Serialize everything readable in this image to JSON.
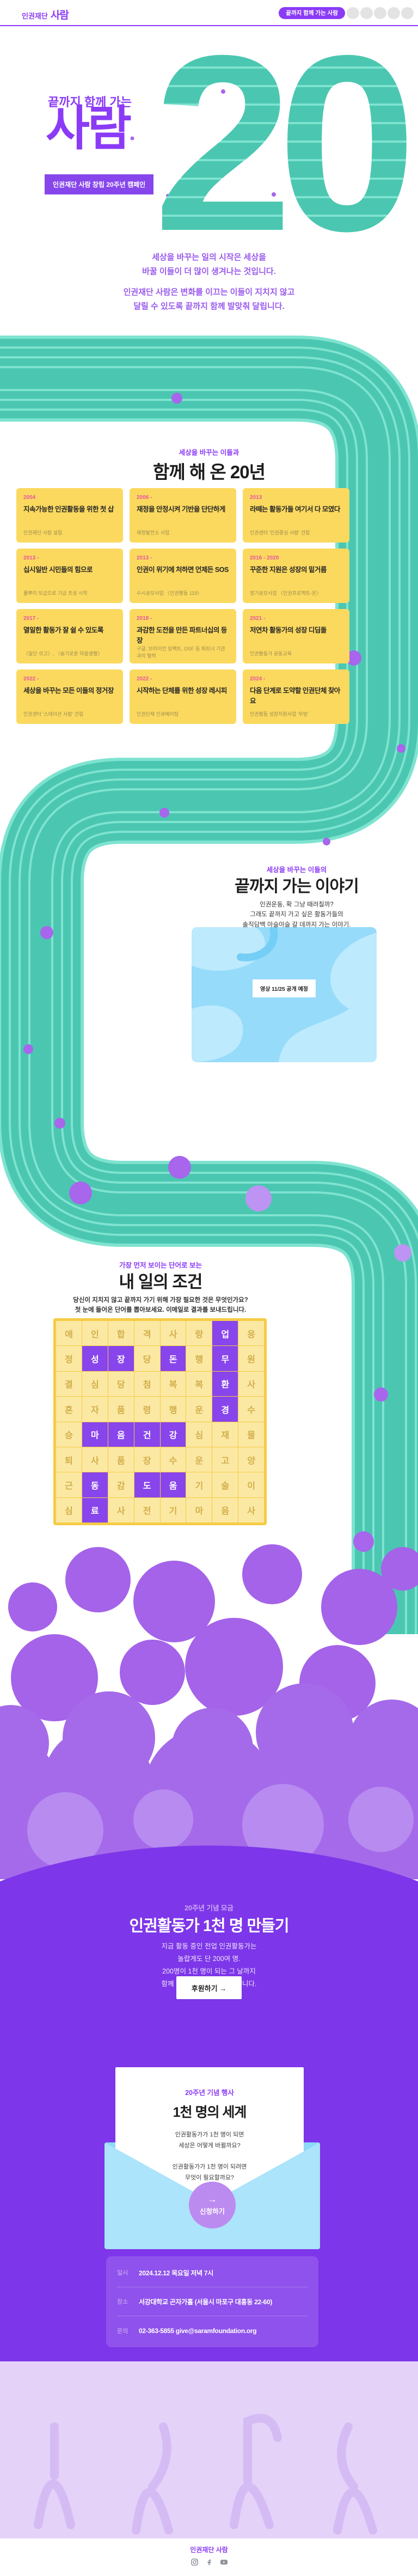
{
  "page_title": "끝까지 함께 가는 사람",
  "palette": {
    "accent_purple": "#8B3BF6",
    "deep_purple": "#7D36E9",
    "cloud_purple": "#A56AE9",
    "track_teal": "#4BC7B1",
    "track_stripe": "#7FE3D0",
    "card_yellow": "#FBD95F",
    "year_pink": "#E8559C",
    "sky_blue": "#ABE4FB",
    "grid_highlight": "#8845EC"
  },
  "header": {
    "logo_prefix": "인권재단",
    "logo_name": "사람",
    "cta": "끝까지 함께 가는 사람"
  },
  "hero": {
    "eyebrow": "끝까지 함께 가는",
    "title": "사람",
    "badge": "인권재단 사람 창립 20주년 캠페인",
    "numeral": "20"
  },
  "intro": {
    "p1": "세상을 바꾸는 일의 시작은 세상을\n바꿀 이들이 더 많이 생겨나는 것입니다.",
    "p2": "인권재단 사람은 변화를 이끄는 이들이 지치지 않고\n달릴 수 있도록 끝까지 함께 발맞춰 달립니다."
  },
  "history": {
    "eyebrow": "세상을 바꾸는 이들과",
    "title": "함께 해 온 20년",
    "cards": [
      {
        "year": "2004",
        "title": "지속가능한 인권활동을 위한 첫 삽",
        "desc": "인권재단 사람 설립"
      },
      {
        "year": "2006 -",
        "title": "재정을 안정시켜 기반을 단단하게",
        "desc": "재정발전소 사업"
      },
      {
        "year": "2013",
        "title": "라떼는 활동가들 여기서 다 모였다",
        "desc": "인권센터 '인권중심 사람' 건립"
      },
      {
        "year": "2013 -",
        "title": "십시일반 시민들의 힘으로",
        "desc": "풀뿌리 모금으로 기금 조성 시작"
      },
      {
        "year": "2013 -",
        "title": "인권이 위기에 처하면 언제든 SOS",
        "desc": "수시공모사업 〈인권활동 119〉"
      },
      {
        "year": "2016 - 2020",
        "title": "꾸준한 지원은 성장의 밑거름",
        "desc": "정기공모사업 〈인권프로젝트-온〉"
      },
      {
        "year": "2017 -",
        "title": "열일한 활동가 잘 쉴 수 있도록",
        "desc": "〈일단 쉬고〉, 〈슬기로운 마음생활〉"
      },
      {
        "year": "2018 -",
        "title": "과감한 도전을 만든 파트너십의 등장",
        "desc": "구글, 브라이언 임팩트, OSF 등 파트너 기관과의 협력"
      },
      {
        "year": "2021 -",
        "title": "저연차 활동가의 성장 디딤돌",
        "desc": "인권활동가 공동교육"
      },
      {
        "year": "2022 -",
        "title": "세상을 바꾸는 모든 이들의 정거장",
        "desc": "인권센터 '스테이션 사람' 건립"
      },
      {
        "year": "2022 -",
        "title": "시작하는 단체를 위한 성장 레시피",
        "desc": "인권단체 인큐베이팅"
      },
      {
        "year": "2024 -",
        "title": "다음 단계로 도약할 인권단체 찾아요",
        "desc": "인권활동 성장지원사업 '무빙'"
      }
    ]
  },
  "story": {
    "eyebrow": "세상을 바꾸는 이들의",
    "title": "끝까지 가는 이야기",
    "body": "인권운동, 확 그냥 때려칠까?\n그래도 끝까지 가고 싶은 활동가들의\n솔직담백 아슬아슬 갈 데까지 가는 이야기.",
    "badge": "영상 11/25 공개 예정"
  },
  "puzzle": {
    "eyebrow": "가장 먼저 보이는 단어로 보는",
    "title": "내 일의 조건",
    "body": "당신이 지치지 않고 끝까지 가기 위해 가장 필요한 것은 무엇인가요?\n첫 눈에 들어온 단어를 뽑아보세요. 이메일로 결과를 보내드립니다.",
    "grid": [
      "애인합격사랑업응",
      "정성장당돈행무원",
      "결심당첨복복환사",
      "혼자품령행운경수",
      "승마음건강심재물",
      "퇴사품장수운고양",
      "근동감도움기술이",
      "심료사전기마음사"
    ],
    "highlights": [
      [
        0,
        6
      ],
      [
        1,
        1
      ],
      [
        1,
        2
      ],
      [
        1,
        4
      ],
      [
        1,
        6
      ],
      [
        2,
        6
      ],
      [
        3,
        6
      ],
      [
        4,
        1
      ],
      [
        4,
        2
      ],
      [
        4,
        3
      ],
      [
        4,
        4
      ],
      [
        6,
        1
      ],
      [
        6,
        3
      ],
      [
        6,
        4
      ],
      [
        7,
        1
      ]
    ],
    "hidden_words": [
      "업무환경",
      "성장",
      "돈",
      "마음건강",
      "동료",
      "도움"
    ]
  },
  "donate": {
    "eyebrow": "20주년 기념 모금",
    "title": "인권활동가 1천 명 만들기",
    "body": "지금 활동 중인 전업 인권활동가는\n놀랍게도 단 200여 명.\n200명이 1천 명이 되는 그 날까지\n함께 달릴 러닝메이트를 구합니다.",
    "button": "후원하기 →"
  },
  "event": {
    "eyebrow": "20주년 기념 행사",
    "title": "1천 명의 세계",
    "body": "인권활동가가 1천 명이 되면\n세상은 어떻게 바뀔까요?\n\n인권활동가가 1천 명이 되려면\n무엇이 필요할까요?\n\n세상을 바꾸는 고민의 장에\n우리와 끝까지 함께 갈 사람,\n당신을 초대합니다.",
    "button_arrow": "→",
    "button": "신청하기",
    "info": [
      {
        "label": "일시",
        "value": "2024.12.12 목요일 저녁 7시"
      },
      {
        "label": "장소",
        "value": "서강대학교 곤자가홀 (서울시 마포구 대흥동 22-60)"
      },
      {
        "label": "문의",
        "value": "02-363-5855  give@saramfoundation.org"
      }
    ]
  },
  "footer": {
    "logo": "인권재단 사람",
    "icons": [
      "instagram-icon",
      "facebook-icon",
      "youtube-icon"
    ]
  }
}
